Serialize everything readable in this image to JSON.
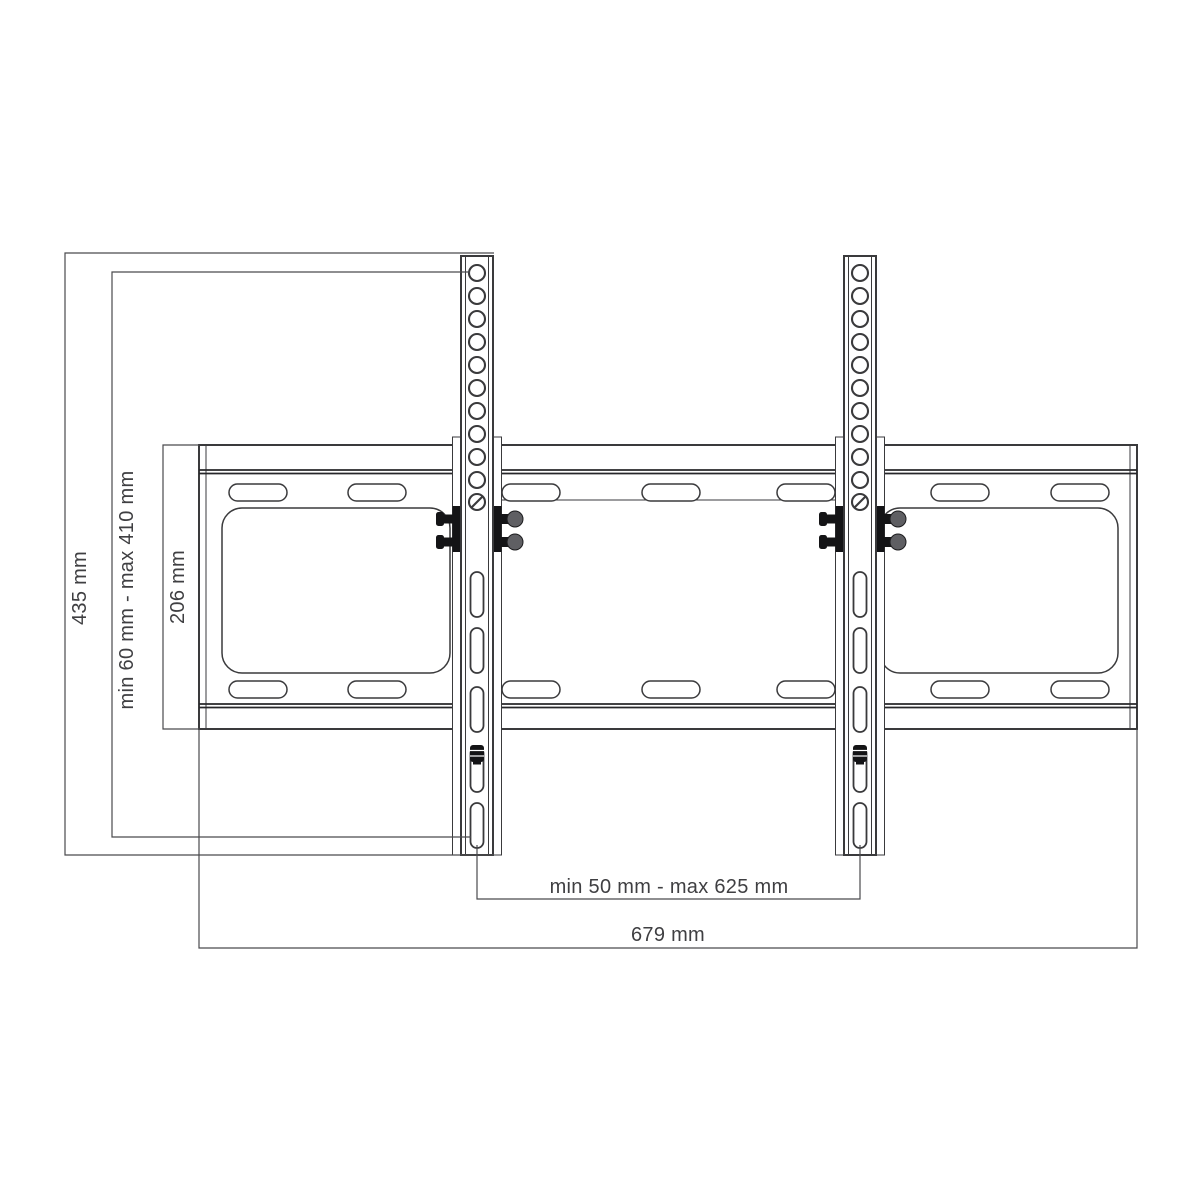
{
  "diagram": {
    "kind": "technical-drawing",
    "subject": "tilting TV wall-mount bracket, front view with dimension lines",
    "dimensions": {
      "total_height": "435 mm",
      "vesa_vertical_range": "min 60 mm - max 410 mm",
      "wall_plate_height": "206 mm",
      "vesa_horizontal_range": "min 50 mm - max 625 mm",
      "total_width": "679 mm"
    },
    "colors": {
      "line": "#3a3a3c",
      "dimension_line": "#4a4a4d",
      "hardware_bolts": "#141416",
      "background": "#ffffff"
    }
  }
}
